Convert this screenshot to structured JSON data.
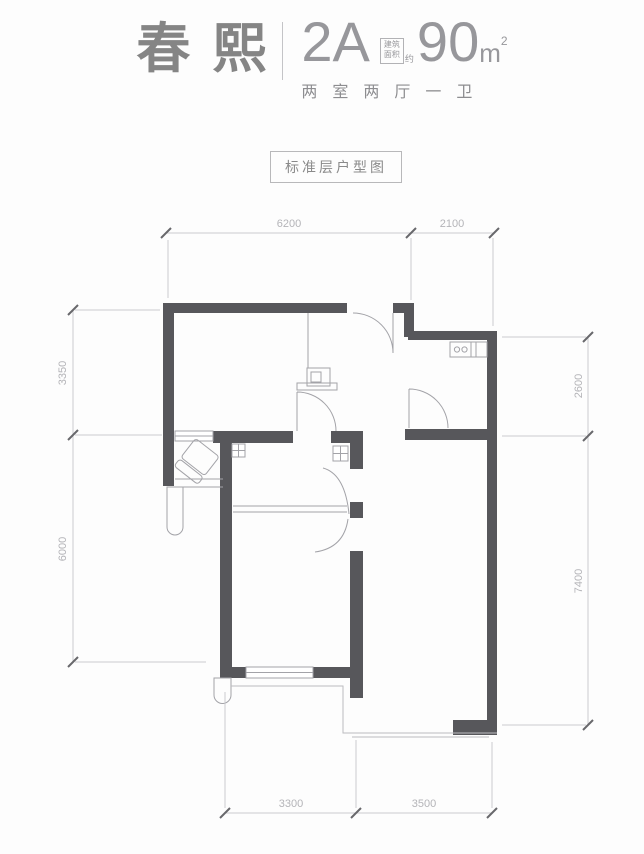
{
  "header": {
    "project_name": "春熙",
    "unit_code": "2A",
    "area_box_line1": "建筑",
    "area_box_line2": "面积",
    "area_approx": "约",
    "area_number": "90",
    "area_unit": "m",
    "area_sup": "2",
    "layout_desc": "两室两厅一卫"
  },
  "plan_title": "标准层户型图",
  "dimensions": {
    "top": [
      "6200",
      "2100"
    ],
    "left": [
      "3350",
      "6000"
    ],
    "right": [
      "2600",
      "7400"
    ],
    "bottom": [
      "3300",
      "3500"
    ]
  },
  "colors": {
    "wall": "#57575b",
    "fixture_line": "#a3a3a8",
    "dimension_line": "#cbcbcf",
    "dimension_text": "#b4b4b8",
    "header_text": "#858585",
    "header_light": "#97979b"
  },
  "fixtures": [
    "entry-door",
    "hall-door",
    "kitchen-door",
    "bath-door",
    "bedroom-door",
    "toilet",
    "bathtub-duct",
    "sink",
    "cabinet",
    "flue-shaft",
    "balcony",
    "window"
  ]
}
